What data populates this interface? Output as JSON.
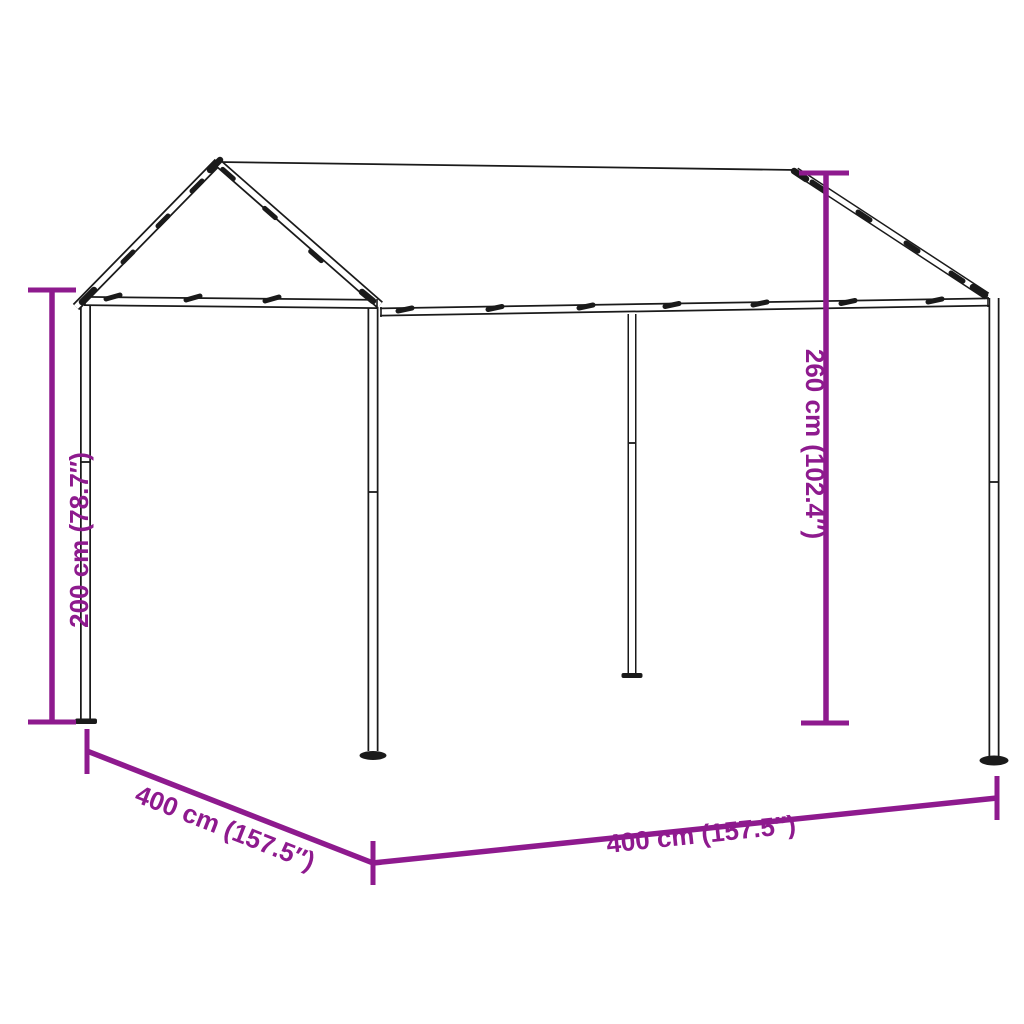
{
  "diagram": {
    "subject": "canopy gazebo steel frame with peaked fabric roof and four posts",
    "dimensions": [
      {
        "id": "height-left",
        "label": "200 cm (78.7″)",
        "value_cm": 200,
        "value_in": 78.7,
        "orientation": "vertical-left"
      },
      {
        "id": "height-right",
        "label": "260 cm (102.4″)",
        "value_cm": 260,
        "value_in": 102.4,
        "orientation": "vertical-right"
      },
      {
        "id": "width-front",
        "label": "400 cm (157.5″)",
        "value_cm": 400,
        "value_in": 157.5,
        "orientation": "diagonal-bottom-left"
      },
      {
        "id": "depth-side",
        "label": "400 cm (157.5″)",
        "value_cm": 400,
        "value_in": 157.5,
        "orientation": "horizontal-bottom"
      }
    ],
    "colors": {
      "dimension_accent": "#8E1A8E",
      "line_art": "#1A1A1A",
      "background": "#FFFFFF"
    }
  }
}
